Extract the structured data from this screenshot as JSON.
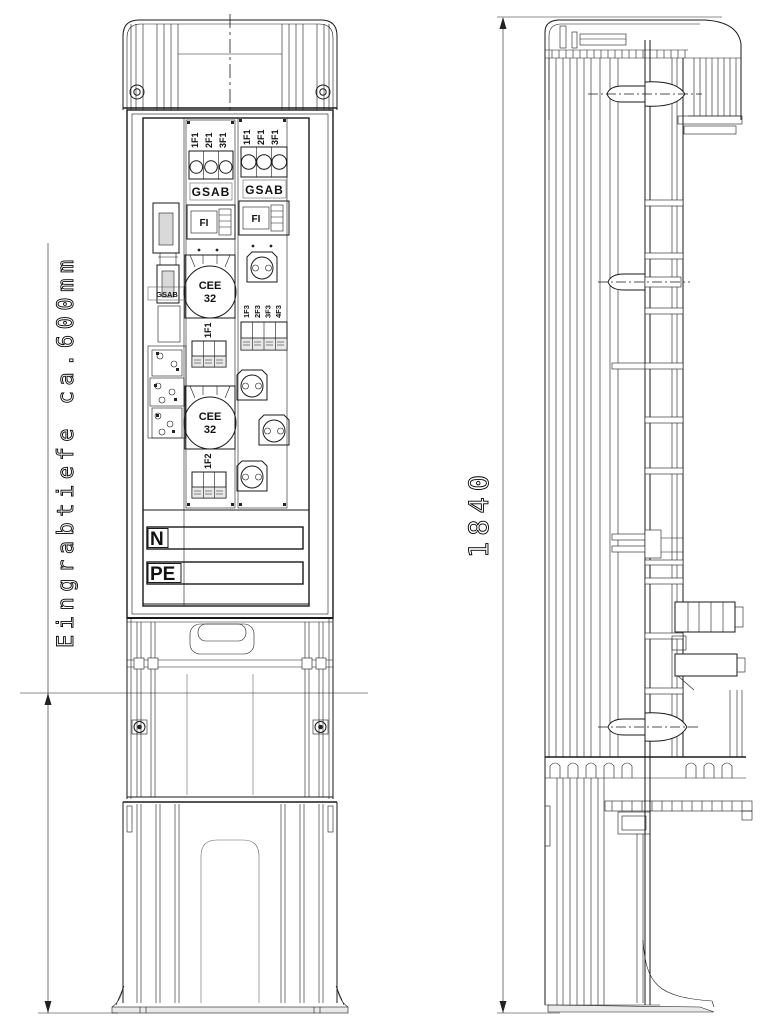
{
  "annotations": {
    "burial_depth": "Eingrabtiefe ca.600mm",
    "height": "1840"
  },
  "front_view": {
    "left_strip": {
      "brand_label": "GSAB"
    },
    "module1": {
      "fuse_labels": [
        "1F1",
        "2F1",
        "3F1"
      ],
      "brand_label": "GSAB",
      "rcd_label": "FI",
      "cee1": {
        "name": "CEE",
        "rating": "32",
        "circuit_label": "1F1"
      },
      "cee2": {
        "name": "CEE",
        "rating": "32",
        "circuit_label": "1F2"
      }
    },
    "module2": {
      "fuse_labels": [
        "1F1",
        "2F1",
        "3F1"
      ],
      "brand_label": "GSAB",
      "rcd_label": "FI",
      "mcb_labels": [
        "1F3",
        "2F3",
        "3F3",
        "4F3"
      ]
    },
    "busbars": {
      "neutral": "N",
      "earth": "PE"
    }
  },
  "colors": {
    "cee_socket_red": "#ee5a52",
    "schuko_socket_blue": "#7aa3df",
    "schuko_socket_inner": "#93b9ec",
    "schuko_border": "#16275c",
    "brand_gray": "#b4b4b4"
  }
}
